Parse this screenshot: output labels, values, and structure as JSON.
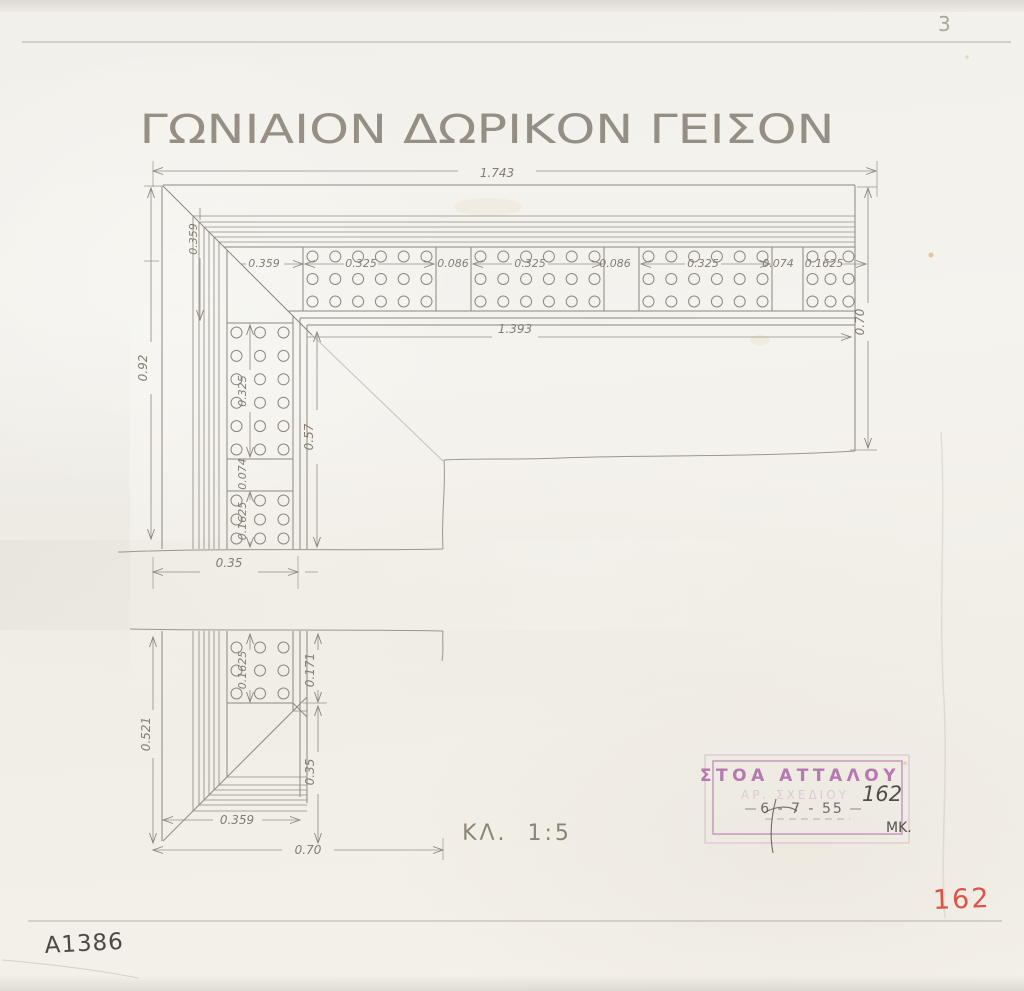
{
  "header": {
    "page_number": "3",
    "title": "ΓΩΝΙΑΙΟΝ ΔΩΡΙΚΟΝ ΓΕΙΣΟΝ"
  },
  "footer": {
    "scale_label": "ΚΛ.  1:5",
    "catalog_number": "A1386",
    "sheet_number_red": "162"
  },
  "stamp": {
    "title": "ΣΤΟΑ ΑΤΤΑΛΟΥ",
    "subtitle_faint": "ΑΡ. ΣΧΕΔΙΟΥ",
    "number": "162",
    "date": "6 - 7 - 55",
    "initials": "ΜΚ."
  },
  "dims": {
    "total_width": "1.743",
    "top_offset": "0.359",
    "top_m1": "0.325",
    "top_g1": "0.086",
    "top_m2": "0.325",
    "top_g2": "0.086",
    "top_m3": "0.325",
    "top_g3": "0.074",
    "top_m4": "0.1625",
    "soffit_length": "1.393",
    "right_depth": "0.70",
    "left_height_upper": "0.92",
    "left_offset": "0.359",
    "soffit_depth": "0.57",
    "left_m1": "0.325",
    "left_g1": "0.074",
    "left_m2": "0.1625",
    "break_width": "0.35",
    "left_m3": "0.1625",
    "inner_step": "0.171",
    "lower_inner": "0.35",
    "left_height_lower": "0.521",
    "bottom_offset": "0.359",
    "bottom_depth": "0.70"
  },
  "colors": {
    "pencil_ink": "#8c8780",
    "dim_text": "#837d72",
    "stamp_purple": "#ac64a8",
    "red_number": "#dc5348",
    "paper": "#f3f1ec"
  },
  "drawing": {
    "gutta_radius": 5.5,
    "margin": 4,
    "top_mutules": [
      {
        "x": 303,
        "y": 247,
        "w": 133,
        "h": 64,
        "cols": 6,
        "rows": 3
      },
      {
        "x": 471,
        "y": 247,
        "w": 133,
        "h": 64,
        "cols": 6,
        "rows": 3
      },
      {
        "x": 639,
        "y": 247,
        "w": 133,
        "h": 64,
        "cols": 6,
        "rows": 3
      },
      {
        "x": 803,
        "y": 247,
        "w": 55,
        "h": 64,
        "cols": 3,
        "rows": 3
      }
    ],
    "left_mutules": [
      {
        "x": 227,
        "y": 323,
        "w": 66,
        "h": 136,
        "cols": 3,
        "rows": 6
      },
      {
        "x": 227,
        "y": 491,
        "w": 66,
        "h": 57,
        "cols": 3,
        "rows": 3
      },
      {
        "x": 227,
        "y": 638,
        "w": 66,
        "h": 65,
        "cols": 3,
        "rows": 3
      }
    ]
  }
}
